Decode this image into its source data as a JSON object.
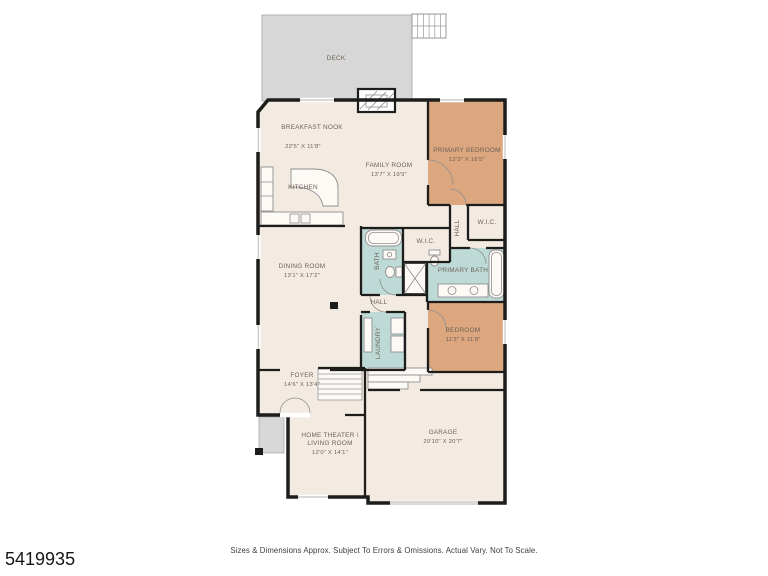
{
  "meta": {
    "mls_number": "5419935",
    "disclaimer": "Sizes & Dimensions Approx. Subject To Errors & Omissions. Actual Vary. Not To Scale."
  },
  "colors": {
    "wall": "#1d1d1b",
    "floor": "#f3ebe2",
    "bedroom_fill": "#dca67e",
    "bath_fill": "#bedad6",
    "deck_fill": "#d6d7d6",
    "label_text": "#6e6157"
  },
  "rooms": {
    "deck": {
      "label": "DECK"
    },
    "breakfast_nook": {
      "label": "BREAKFAST NOOK",
      "dims": "22'5\" X 11'8\""
    },
    "kitchen": {
      "label": "KITCHEN"
    },
    "family_room": {
      "label": "FAMILY ROOM",
      "dims": "13'7\" X 19'9\""
    },
    "primary_bedroom": {
      "label": "PRIMARY BEDROOM",
      "dims": "12'3\" X 16'5\""
    },
    "wic_primary": {
      "label": "W.I.C."
    },
    "hall_upper": {
      "label": "HALL"
    },
    "wic_hall": {
      "label": "W.I.C."
    },
    "bath": {
      "label": "BATH"
    },
    "primary_bath": {
      "label": "PRIMARY BATH"
    },
    "dining_room": {
      "label": "DINING ROOM",
      "dims": "13'1\" X 17'2\""
    },
    "hall": {
      "label": "HALL"
    },
    "bedroom": {
      "label": "BEDROOM",
      "dims": "11'3\" X 11'8\""
    },
    "laundry": {
      "label": "LAUNDRY"
    },
    "foyer": {
      "label": "FOYER",
      "dims": "14'6\" X 13'4\""
    },
    "home_theater": {
      "label_line1": "HOME THEATER \\",
      "label_line2": "LIVING ROOM",
      "dims": "12'0\" X 14'1\""
    },
    "garage": {
      "label": "GARAGE",
      "dims": "20'10\" X 20'7\""
    }
  }
}
